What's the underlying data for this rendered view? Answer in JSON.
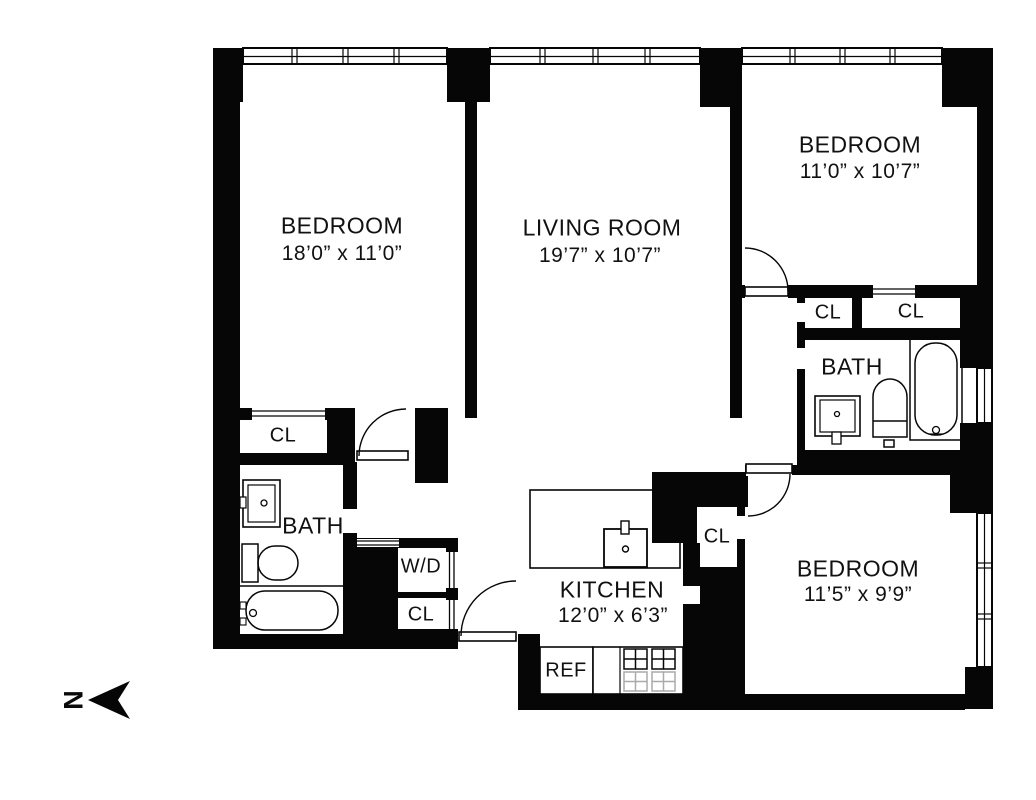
{
  "plan": {
    "title": "apartment-floor-plan",
    "compass": {
      "letter": "N"
    },
    "rooms": {
      "bedroom1": {
        "name": "BEDROOM",
        "dims": "18’0” x 11’0”"
      },
      "living": {
        "name": "LIVING ROOM",
        "dims": "19’7” x 10’7”"
      },
      "bedroom2": {
        "name": "BEDROOM",
        "dims": "11’0” x 10’7”"
      },
      "bedroom3": {
        "name": "BEDROOM",
        "dims": "11’5” x 9’9”"
      },
      "kitchen": {
        "name": "KITCHEN",
        "dims": "12’0” x 6’3”"
      },
      "bath_left": {
        "name": "BATH"
      },
      "bath_right": {
        "name": "BATH"
      }
    },
    "closets": {
      "cl_bedroom1": "CL",
      "washer_dryer": "W/D",
      "cl_laundry": "CL",
      "cl_kitchen": "CL",
      "cl_hall": "CL",
      "cl_bedroom2": "CL"
    },
    "appliances": {
      "refrigerator": "REF"
    },
    "colors": {
      "wall": "#060606",
      "background": "#ffffff",
      "ghost_fixture": "#aaaaaa"
    }
  }
}
